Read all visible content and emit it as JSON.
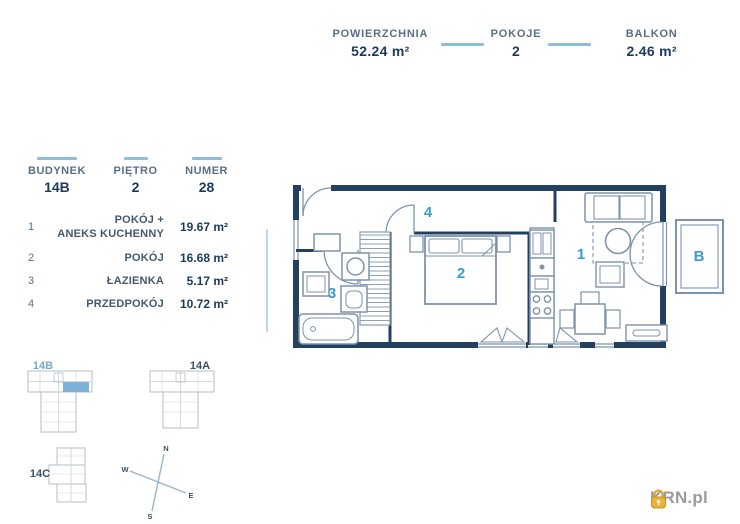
{
  "header": {
    "stats": [
      {
        "label": "POWIERZCHNIA",
        "value": "52.24 m²"
      },
      {
        "label": "POKOJE",
        "value": "2"
      },
      {
        "label": "BALKON",
        "value": "2.46 m²"
      }
    ]
  },
  "unit_info": {
    "stats": [
      {
        "label": "BUDYNEK",
        "value": "14B"
      },
      {
        "label": "PIĘTRO",
        "value": "2"
      },
      {
        "label": "NUMER",
        "value": "28"
      }
    ]
  },
  "rooms": [
    {
      "no": "1",
      "name": "POKÓJ +\nANEKS KUCHENNY",
      "area": "19.67 m²"
    },
    {
      "no": "2",
      "name": "POKÓJ",
      "area": "16.68 m²"
    },
    {
      "no": "3",
      "name": "ŁAZIENKA",
      "area": "5.17 m²"
    },
    {
      "no": "4",
      "name": "PRZEDPOKÓJ",
      "area": "10.72 m²"
    }
  ],
  "plan": {
    "labels": {
      "living": "1",
      "bedroom": "2",
      "bathroom": "3",
      "hall": "4",
      "balcony": "B"
    }
  },
  "minimap": {
    "b14b": "14B",
    "b14a": "14A",
    "b14c": "14C"
  },
  "compass": {
    "n": "N",
    "e": "E",
    "s": "S",
    "w": "W"
  },
  "logo": {
    "text": "KRN.pl"
  },
  "colors": {
    "accent": "#3a9ad2",
    "wall": "#24405f",
    "line": "#7d93ab",
    "divider": "#8fbcd9",
    "highlight": "#6fa8d4",
    "logo_gold": "#e8b337"
  }
}
